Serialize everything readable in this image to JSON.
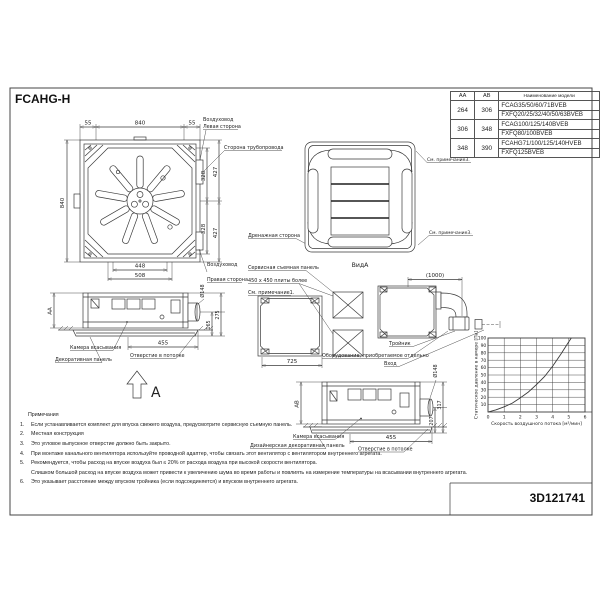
{
  "title": "FCAHG-H",
  "doc_id": "3D121741",
  "model_table": {
    "headers": {
      "aa": "АА",
      "ab": "АВ",
      "model": "Наименование модели"
    },
    "rows": [
      {
        "aa": "264",
        "ab": "306",
        "model1": "FCAG35/50/60/71BVEB",
        "model2": "FXFQ20/25/32/40/50/63BVEB"
      },
      {
        "aa": "306",
        "ab": "348",
        "model1": "FCAG100/125/140BVEB",
        "model2": "FXFQ80/100BVEB"
      },
      {
        "aa": "348",
        "ab": "390",
        "model1": "FCAHG71/100/125/140HVEB",
        "model2": "FXFQ125BVEB"
      }
    ]
  },
  "plan_view": {
    "dim_top_left": "55",
    "dim_top_center": "840",
    "dim_top_right": "55",
    "dim_left": "840",
    "dim_right_inner_top": "328",
    "dim_right_outer_top": "427",
    "dim_right_inner_bottom": "328",
    "dim_right_outer_bottom": "427",
    "dim_bottom_inner": "448",
    "dim_bottom_outer": "508",
    "label_duct_top": "Воздуховод",
    "label_left_side": "Левая сторона",
    "label_piping_side": "Сторона трубопровода",
    "label_drain_side": "Дренажная сторона",
    "label_duct_bottom": "Воздуховод",
    "label_right_side": "Правая сторона"
  },
  "panel_view": {
    "label_note3_top": "См. примечание3.",
    "label_note3_bottom": "См. примечание3.",
    "label_view": "ВидА"
  },
  "side_view_aa": {
    "dim_height": "АА",
    "dim_bottom": "455",
    "dim_right_inner": "165",
    "dim_right_outer": "275",
    "dim_duct": "Ø148",
    "label_suction": "Камера всасывания",
    "label_panel": "Декоративная панель",
    "label_ceiling": "Отверстие в потолке",
    "view_arrow": "A"
  },
  "opening_view": {
    "label_service": "Сервисная съемная панель",
    "label_plates": "450 x 450 плиты более",
    "label_note1": "См. примечание1.",
    "dim_width": "725",
    "label_equipment": "Оборудование, приобретаемое отдельно"
  },
  "duct_view": {
    "dim_top": "(1000)",
    "label_tee": "Тройник",
    "label_inlet": "Вход"
  },
  "side_view_ab": {
    "dim_height": "АВ",
    "dim_bottom": "455",
    "dim_right_inner": "207",
    "dim_right_outer": "317",
    "dim_duct": "Ø148",
    "label_suction": "Камера всасывания",
    "label_panel": "Дизайнерская декоративная панель",
    "label_ceiling": "Отверстие в потолке"
  },
  "notes": {
    "heading": "Примечания",
    "items": [
      {
        "num": "1.",
        "text": "Если устанавливается комплект для впуска свежего воздуха, предусмотрите сервисную съемную панель."
      },
      {
        "num": "2.",
        "text": "Местная конструкция"
      },
      {
        "num": "3.",
        "text": "Это угловое выпускное отверстие должно быть закрыто."
      },
      {
        "num": "4.",
        "text": "При монтаже канального вентилятора используйте проводной адаптер, чтобы связать этот вентилятор с вентилятором внутреннего агрегата."
      },
      {
        "num": "5.",
        "text": "Рекомендуется, чтобы расход на впуске воздуха был ≤ 20% от расхода воздуха при высокой скорости вентилятора."
      },
      {
        "num": "",
        "text": "Слишком большой расход на впуске воздуха может привести к увеличению шума во время работы и повлиять на измерение температуры на всасывании внутреннего агрегата."
      },
      {
        "num": "6.",
        "text": "Это указывает расстояние между впуском тройника (если подсоединяется) и впуском внутреннего агрегата."
      }
    ]
  },
  "chart_data": {
    "type": "line",
    "title": "",
    "xlabel": "Скорость воздушного потока [м³/мин]",
    "ylabel": "Статическое давление в камере [Па]",
    "xlim": [
      0,
      6
    ],
    "ylim": [
      0,
      100
    ],
    "xticks": [
      0,
      1,
      2,
      3,
      4,
      5,
      6
    ],
    "yticks": [
      10,
      20,
      30,
      40,
      50,
      60,
      70,
      80,
      90,
      100
    ],
    "grid": true,
    "legend": false,
    "series": [
      {
        "name": "fan-static-pressure-curve",
        "x": [
          0,
          0.5,
          1,
          1.5,
          2,
          2.5,
          3,
          3.5,
          4,
          4.5,
          5,
          5.15
        ],
        "y": [
          0,
          3,
          7,
          12,
          19,
          27,
          37,
          48,
          62,
          78,
          95,
          100
        ]
      }
    ]
  }
}
